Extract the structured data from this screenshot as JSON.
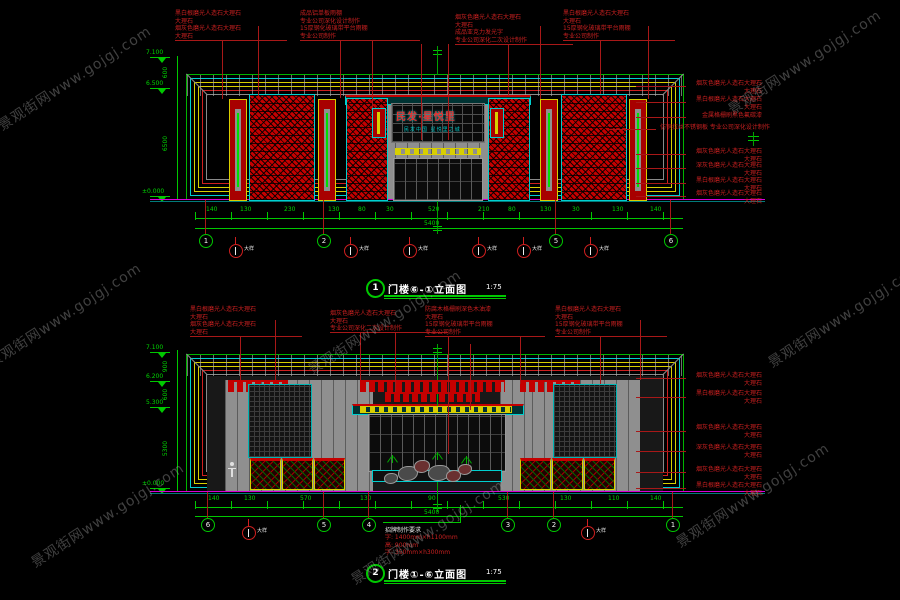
{
  "watermark": {
    "text": "景观街网www.gojgj.com"
  },
  "colors": {
    "green": "#00c800",
    "cyan": "#00cfcf",
    "yellow": "#d8cf00",
    "red": "#cf1f1f",
    "magenta": "#d800d8"
  },
  "drawing1": {
    "title": {
      "num": "1",
      "name": "门楼⑥-①立面图",
      "scale": "1:75"
    },
    "sign": {
      "main": "民发·星悦里",
      "sub": "民发中国 星悦里之城"
    },
    "levels": [
      {
        "v": "7.100"
      },
      {
        "v": "6.500"
      },
      {
        "v": "±0.000"
      }
    ],
    "vdims": [
      "600",
      "6500"
    ],
    "top_callouts": [
      {
        "lines": [
          "黑白根磨光人造石大理石",
          "大理石",
          "烟灰色磨光人造石大理石",
          "大理石"
        ]
      },
      {
        "lines": [
          "成品铝单板雨棚",
          "专业公司深化设计制作",
          "15厚钢化玻璃带平台雨棚",
          "专业公司制作"
        ]
      },
      {
        "lines": [
          "烟灰色磨光人造石大理石",
          "大理石",
          "成品亚克力发光字",
          "专业公司深化二次设计制作"
        ]
      },
      {
        "lines": [
          "黑白根磨光人造石大理石",
          "大理石",
          "15厚钢化玻璃带平台雨棚",
          "专业公司制作"
        ]
      }
    ],
    "right_callouts": [
      {
        "lines": [
          "烟灰色磨光人造石大理石",
          "大理石"
        ]
      },
      {
        "lines": [
          "黑白根磨光人造石大理石",
          "大理石"
        ]
      },
      {
        "lines": [
          "金属格栅刷黑色氟碳漆"
        ]
      },
      {
        "lines": [
          "仿铜拉丝不锈钢板 专业公司深化设计制作"
        ]
      },
      {
        "lines": [
          "烟灰色磨光人造石大理石",
          "大理石"
        ]
      },
      {
        "lines": [
          "深灰色磨光人造石大理石",
          "大理石"
        ]
      },
      {
        "lines": [
          "黑白根磨光人造石大理石",
          "大理石"
        ]
      },
      {
        "lines": [
          "烟灰色磨光人造石大理石",
          "大理石"
        ]
      }
    ],
    "dims": [
      "140",
      "130",
      "230",
      "130",
      "80",
      "30",
      "210",
      "80",
      "130",
      "30",
      "130",
      "140"
    ],
    "center_dim": "520",
    "total": "5400",
    "bubbles": [
      "1",
      "2",
      "5",
      "6"
    ],
    "marker_label": "大样"
  },
  "drawing2": {
    "title": {
      "num": "2",
      "name": "门楼①-⑥立面图",
      "scale": "1:75"
    },
    "levels": [
      {
        "v": "7.100"
      },
      {
        "v": "6.200"
      },
      {
        "v": "5.300"
      },
      {
        "v": "±0.000"
      }
    ],
    "vdims": [
      "900",
      "600",
      "5300"
    ],
    "top_callouts": [
      {
        "lines": [
          "黑白根磨光人造石大理石",
          "大理石",
          "烟灰色磨光人造石大理石",
          "大理石"
        ]
      },
      {
        "lines": [
          "烟灰色磨光人造石大理石",
          "大理石",
          "专业公司深化二次设计制作"
        ]
      },
      {
        "lines": [
          "防腐木格栅刷深色木油漆",
          "大理石",
          "15厚钢化玻璃带平台雨棚",
          "专业公司制作"
        ]
      },
      {
        "lines": [
          "黑白根磨光人造石大理石",
          "大理石",
          "15厚钢化玻璃带平台雨棚",
          "专业公司制作"
        ]
      }
    ],
    "right_callouts": [
      {
        "lines": [
          "烟灰色磨光人造石大理石",
          "大理石"
        ]
      },
      {
        "lines": [
          "黑白根磨光人造石大理石",
          "大理石"
        ]
      },
      {
        "lines": [
          "烟灰色磨光人造石大理石",
          "大理石"
        ]
      },
      {
        "lines": [
          "深灰色磨光人造石大理石",
          "大理石"
        ]
      },
      {
        "lines": [
          "烟灰色磨光人造石大理石",
          "大理石"
        ]
      },
      {
        "lines": [
          "黑白根磨光人造石大理石",
          "大理石"
        ]
      }
    ],
    "dims": [
      "140",
      "130",
      "570",
      "130",
      "90",
      "530",
      "130",
      "110",
      "140"
    ],
    "total": "5400",
    "bubbles": [
      "6",
      "5",
      "4",
      "3",
      "2",
      "1"
    ],
    "marker_label": "大样",
    "note": {
      "title": "招牌制作要求",
      "lines": [
        "字: 1400mm×h1100mm",
        "高: 900mm",
        "字: 350mm×h300mm"
      ]
    }
  }
}
